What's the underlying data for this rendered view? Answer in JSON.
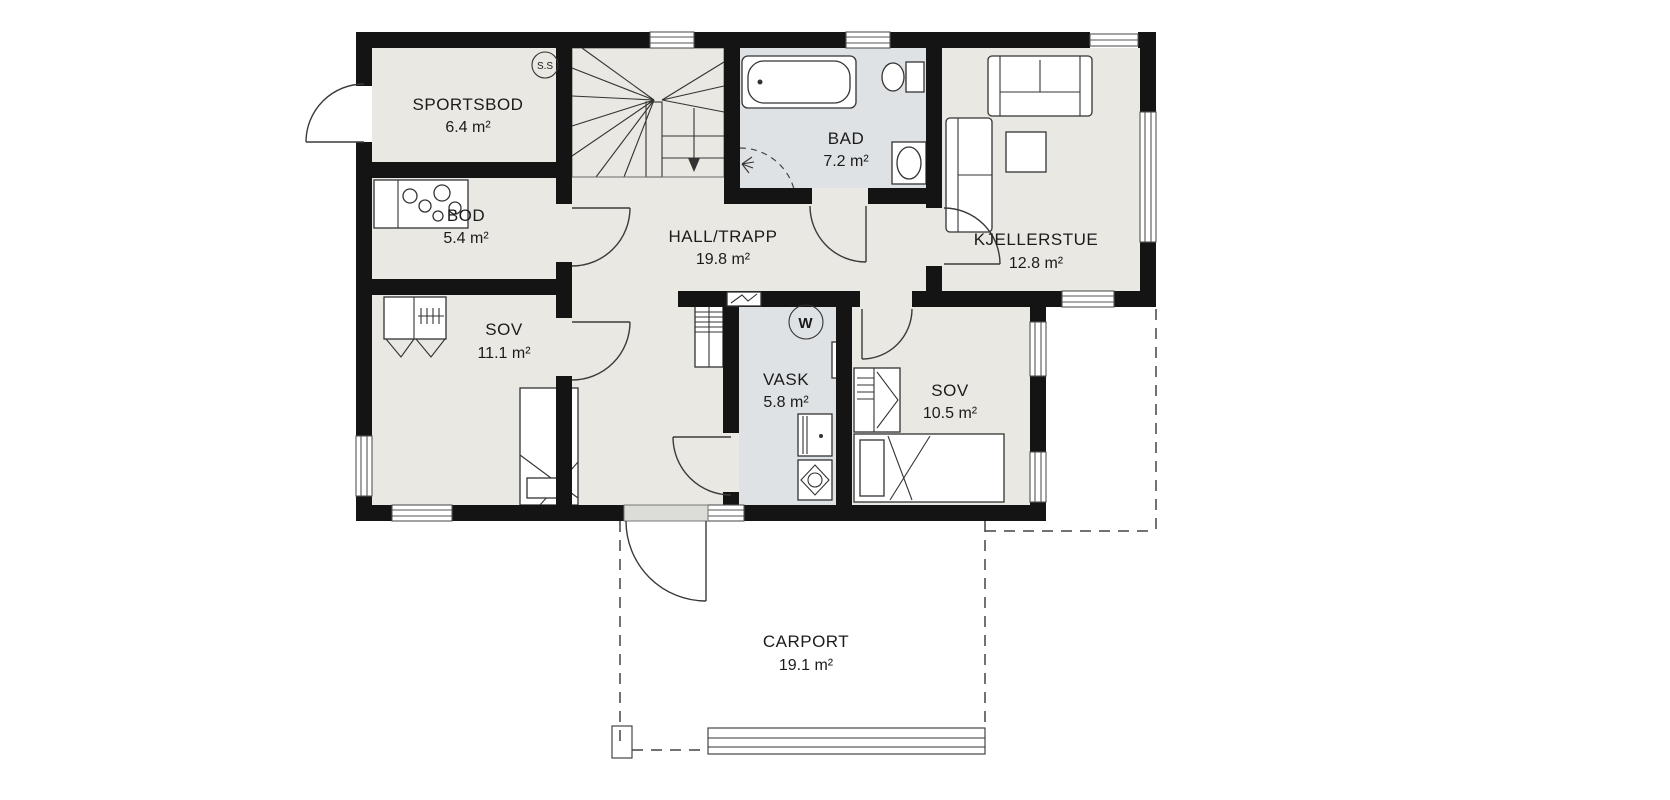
{
  "floor_plan": {
    "rooms": [
      {
        "id": "sportsbod",
        "name": "SPORTSBOD",
        "area": "6.4 m²"
      },
      {
        "id": "bod",
        "name": "BOD",
        "area": "5.4 m²"
      },
      {
        "id": "hall_trapp",
        "name": "HALL/TRAPP",
        "area": "19.8 m²"
      },
      {
        "id": "bad",
        "name": "BAD",
        "area": "7.2 m²"
      },
      {
        "id": "kjellerstue",
        "name": "KJELLERSTUE",
        "area": "12.8 m²"
      },
      {
        "id": "sov_1",
        "name": "SOV",
        "area": "11.1 m²"
      },
      {
        "id": "vask",
        "name": "VASK",
        "area": "5.8 m²"
      },
      {
        "id": "sov_2",
        "name": "SOV",
        "area": "10.5 m²"
      },
      {
        "id": "carport",
        "name": "CARPORT",
        "area": "19.1 m²"
      }
    ],
    "markers": {
      "section_circle": "S.S",
      "water_heater": "W"
    },
    "colors": {
      "wall": "#141414",
      "room_fill": "#e9e8e2",
      "wet_room_fill": "#dfe2e4",
      "line": "#3a3a3a",
      "background": "#ffffff"
    }
  }
}
